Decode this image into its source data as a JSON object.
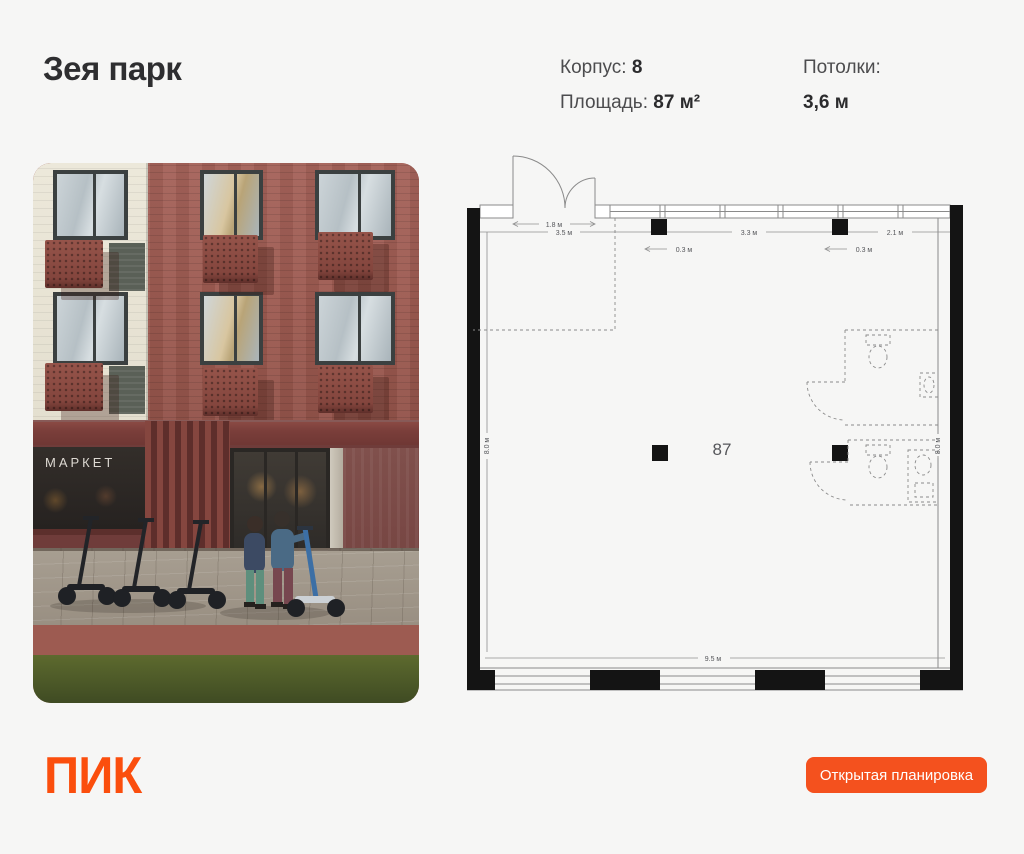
{
  "header": {
    "title": "Зея парк",
    "korpus_label": "Корпус:",
    "korpus_value": "8",
    "area_label": "Площадь:",
    "area_value": "87 м²",
    "ceiling_label": "Потолки:",
    "ceiling_value": "3,6 м"
  },
  "photo": {
    "storefront_sign": "МАРКЕТ"
  },
  "floor_plan": {
    "unit_label": "87",
    "dims": {
      "door": "1.8 м",
      "top_left": "3.5 м",
      "top_mid": "3.3 м",
      "top_right": "2.1 м",
      "col_left": "0.3 м",
      "col_right": "0.3 м",
      "left_side": "8.0 м",
      "right_side": "8.0 м",
      "bottom": "9.5 м"
    }
  },
  "footer": {
    "logo": "ПИК",
    "button_label": "Открытая планировка"
  },
  "colors": {
    "background": "#f6f6f5",
    "brand_orange": "#fb4e0d",
    "button_orange": "#f4511e",
    "heading_text": "#2e2e30",
    "plan_wall": "#141414",
    "plan_line": "#8a8a8a"
  }
}
